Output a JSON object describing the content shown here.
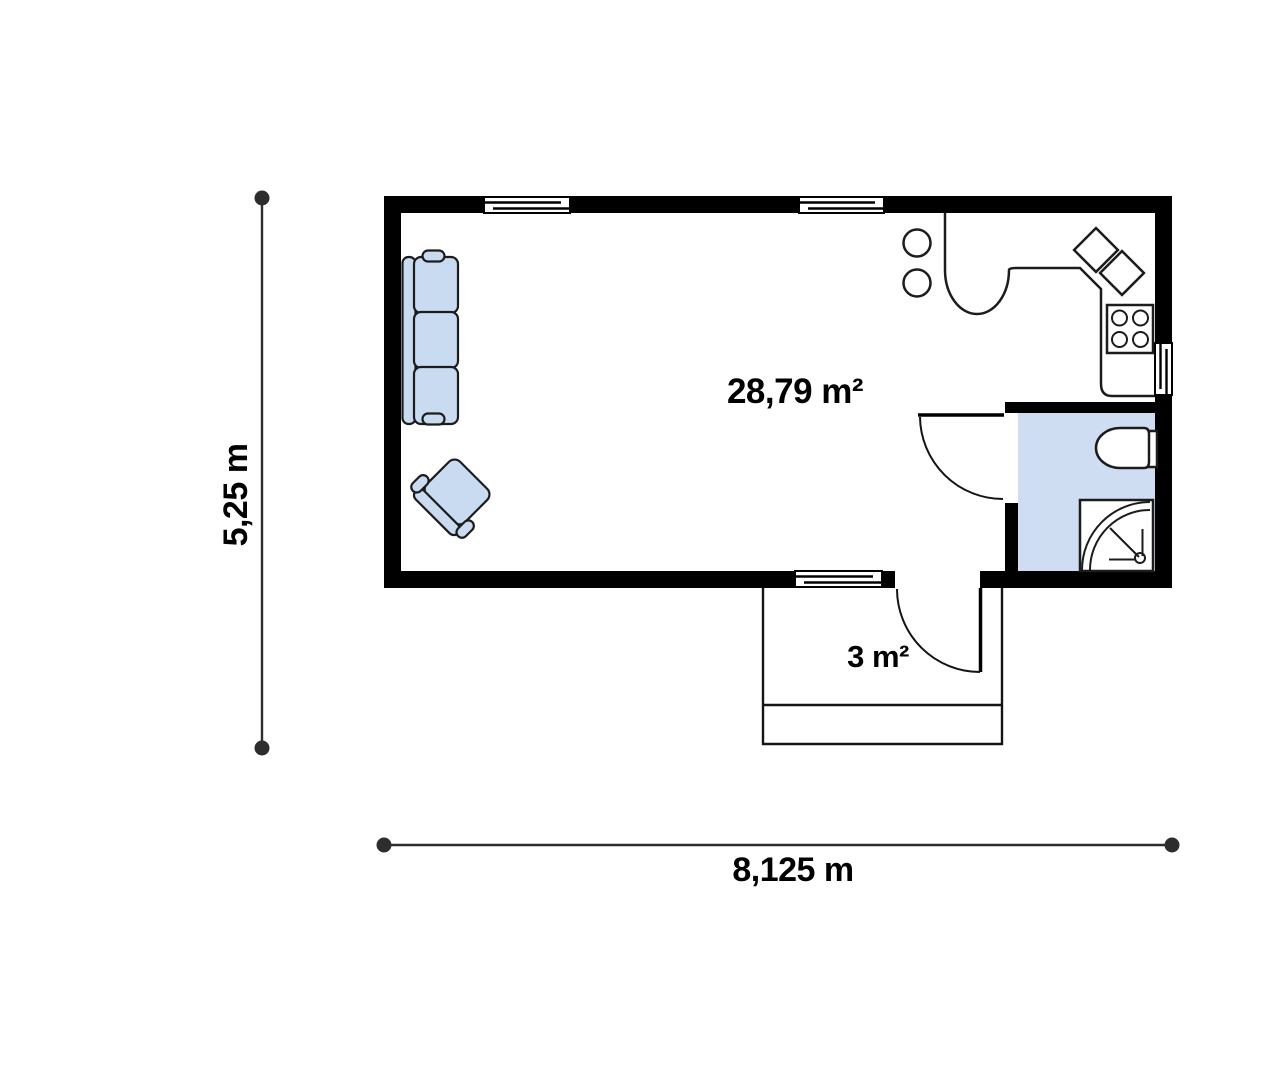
{
  "floor_plan": {
    "labels": {
      "main_room_area": "28,79 m²",
      "entrance_area": "3 m²",
      "overall_width": "8,125 m",
      "overall_depth": "5,25 m"
    },
    "colors": {
      "wall": "#000000",
      "line": "#1c1c1c",
      "furniture_fill": "#c9dbf1",
      "bathroom_floor_fill": "#cfddf2",
      "dimension_line": "#2d2d2d",
      "label_text": "#000000"
    }
  }
}
